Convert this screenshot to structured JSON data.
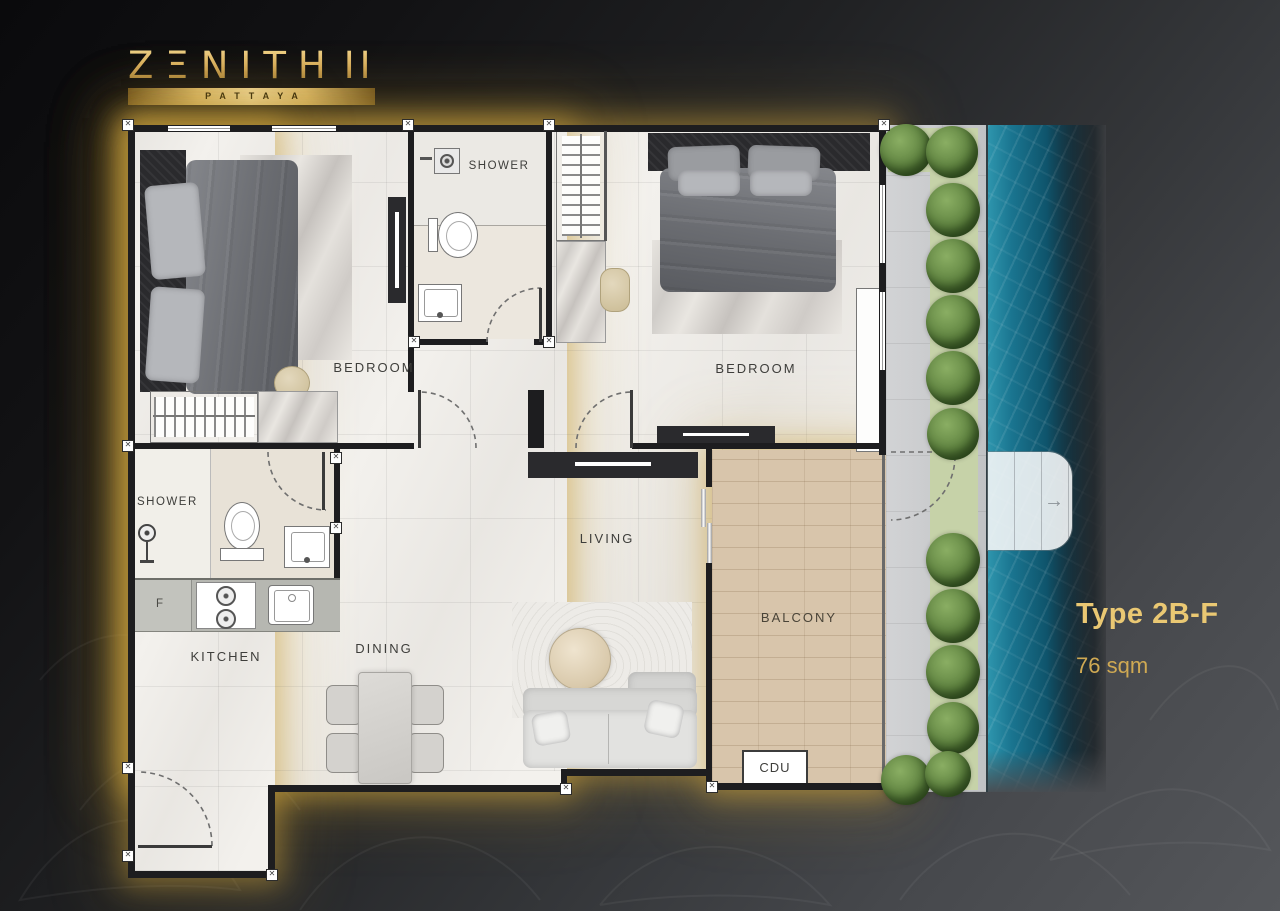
{
  "logo": {
    "title": "ZΞNITH",
    "suffix": "II",
    "subtitle": "PATTAYA"
  },
  "unit": {
    "type": "Type 2B-F",
    "area": "76 sqm"
  },
  "rooms": {
    "shower_top": "SHOWER",
    "shower_bottom": "SHOWER",
    "bedroom_left": "BEDROOM",
    "bedroom_right": "BEDROOM",
    "living": "LIVING",
    "kitchen": "KITCHEN",
    "dining": "DINING",
    "balcony": "BALCONY",
    "cdu": "CDU",
    "fridge": "F"
  },
  "colors": {
    "gold": "#d9b264",
    "wall": "#1d1d1f",
    "floor": "#f3f1ed",
    "wood": "#d8c5ab",
    "pool_blue": "#11617c",
    "shrub_green": "#5f8340",
    "background": "#2f3134"
  }
}
